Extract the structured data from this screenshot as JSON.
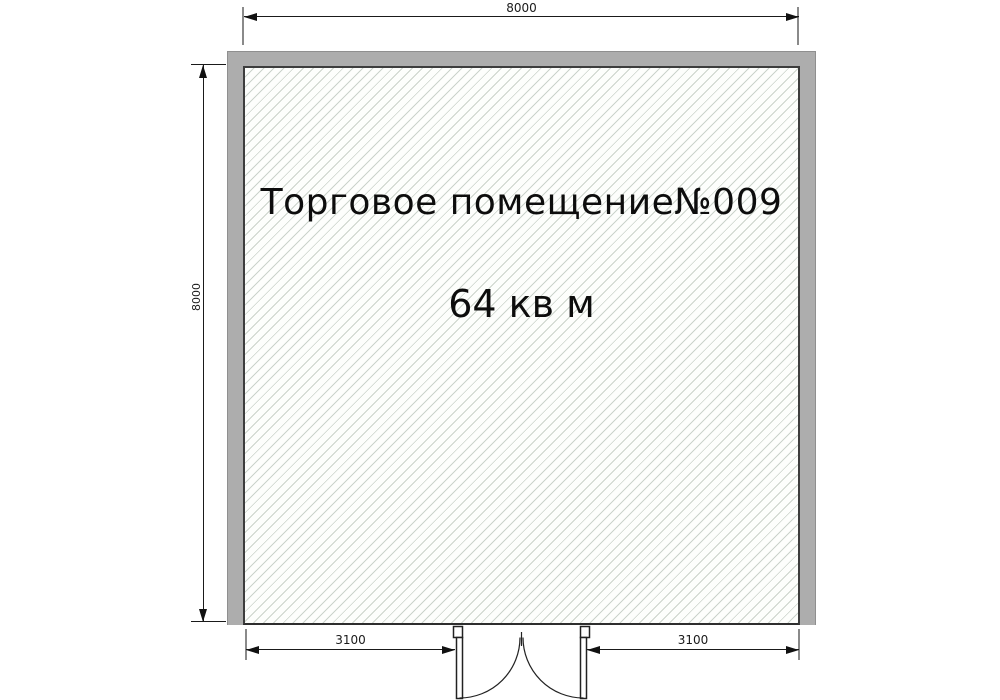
{
  "plan": {
    "room": {
      "name": "Торговое помещение№009",
      "area": "64 кв м"
    },
    "dimensions": {
      "top_width": "8000",
      "left_height": "8000",
      "bottom_left_segment": "3100",
      "bottom_right_segment": "3100"
    },
    "door": {
      "type": "double-swing-door",
      "location": "bottom-center"
    },
    "colors": {
      "wall_fill": "#adadad",
      "wall_outer_outline": "#8f8f8f",
      "wall_inner_outline": "#3d3d3d",
      "hatch_line": "#cbd3cb",
      "hatch_background": "#fdfefc",
      "dimension_line": "#1a1a1a",
      "extension_line": "#8a8a8a",
      "background": "#ffffff",
      "text": "#0d0d0d"
    }
  }
}
